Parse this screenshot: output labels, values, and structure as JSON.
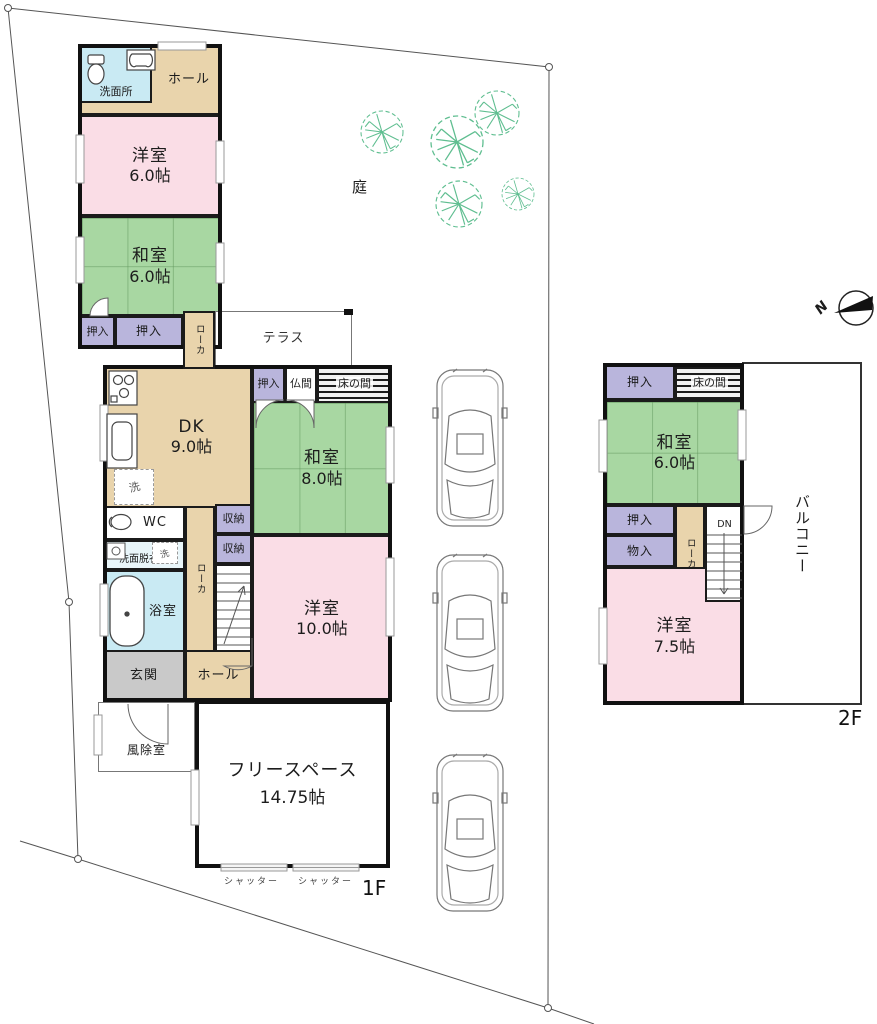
{
  "site": {
    "garden_label": "庭",
    "compass_n": "N",
    "floor1_label": "1F",
    "floor2_label": "2F"
  },
  "floor1": {
    "senmenjo": "洗面所",
    "hall_upper": "ホール",
    "yoshitsu6": {
      "name": "洋室",
      "size": "6.0帖"
    },
    "washitsu6": {
      "name": "和室",
      "size": "6.0帖"
    },
    "oshiire_left": "押入",
    "oshiire_right": "押入",
    "roka_upper": "ローカ",
    "terrace": "テラス",
    "dk": {
      "name": "DK",
      "size": "9.0帖"
    },
    "oshiire_dk": "押入",
    "butsuma": "仏間",
    "tokonoma": "床の間",
    "washitsu8": {
      "name": "和室",
      "size": "8.0帖"
    },
    "laundry_dk": "洗",
    "wc": "WC",
    "shuno_top": "収納",
    "shuno_bottom": "収納",
    "senmen_datsui": "洗面脱衣室",
    "laundry_datsui": "洗",
    "yokushitsu": "浴室",
    "roka_lower": "ローカ",
    "yoshitsu10": {
      "name": "洋室",
      "size": "10.0帖"
    },
    "genkan": "玄関",
    "hall_lower": "ホール",
    "fujoshitsu": "風除室",
    "freespace": {
      "name": "フリースペース",
      "size": "14.75帖"
    },
    "shutter_left": "シャッター",
    "shutter_right": "シャッター"
  },
  "floor2": {
    "oshiire_top": "押入",
    "tokonoma": "床の間",
    "washitsu6": {
      "name": "和室",
      "size": "6.0帖"
    },
    "oshiire_mid": "押入",
    "monoiire": "物入",
    "roka": "ローカ",
    "dn": "DN",
    "yoshitsu75": {
      "name": "洋室",
      "size": "7.5帖"
    },
    "balcony": "バルコニー"
  },
  "colors": {
    "western_room_pink": "#fadde6",
    "japanese_room_green": "#a8d7a2",
    "closet_purple": "#b9b5dc",
    "corridor_tan": "#e9d4ac",
    "wet_area_cyan": "#c9eaf3",
    "dressing_light": "#e9f6fa",
    "entrance_gray": "#c9c9c9",
    "wall_black": "#111111",
    "tree_green": "#63c094",
    "boundary_gray": "#555555"
  }
}
